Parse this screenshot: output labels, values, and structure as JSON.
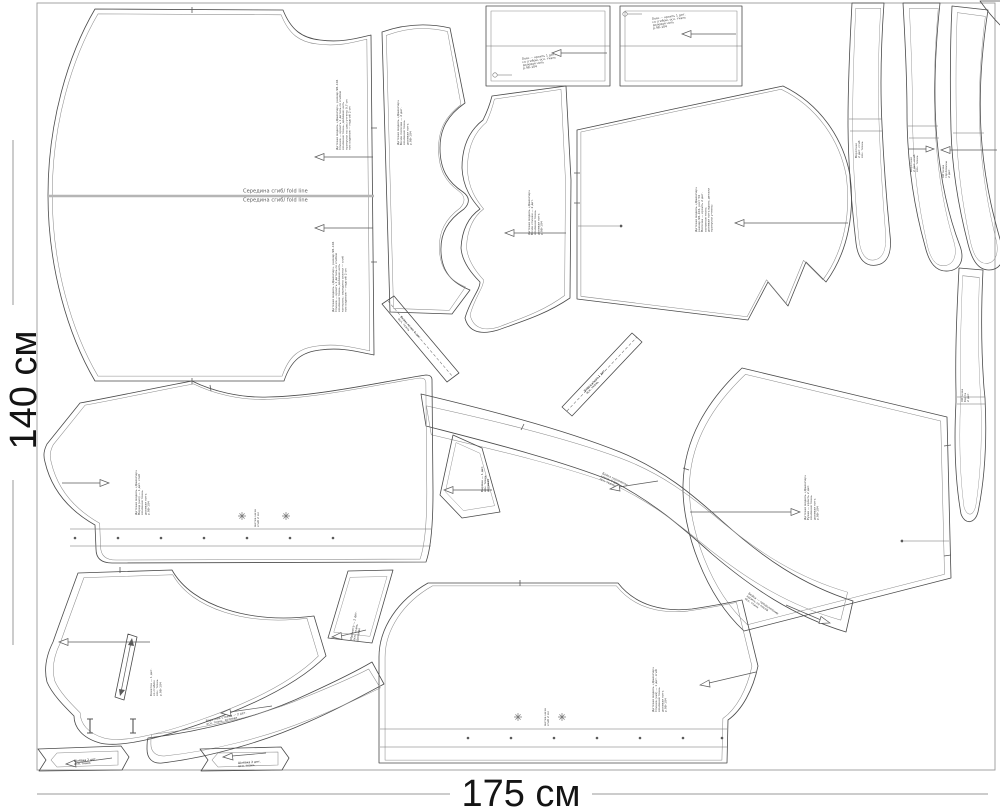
{
  "page": {
    "background": "#ffffff",
    "piece_line_color": "#4a4a4a",
    "inner_line_color": "#8a8a8a",
    "fold_line_color": "#b5b5b5",
    "dim_text_color": "#141414"
  },
  "dimensions": {
    "height_label": "140 см",
    "width_label": "175 см"
  },
  "fold_line": {
    "label_above": "Середина сгиб/ fold line",
    "label_below": "Середина сгиб/ fold line"
  },
  "marks": {
    "dot_rows": [
      {
        "y": 538,
        "xs": [
          75,
          118,
          161,
          204,
          247,
          290,
          333
        ]
      },
      {
        "y": 738,
        "xs": [
          468,
          511,
          554,
          597,
          640,
          683,
          722
        ]
      }
    ],
    "crosses": [
      [
        242,
        516
      ],
      [
        286,
        516
      ],
      [
        518,
        717
      ],
      [
        562,
        717
      ]
    ]
  },
  "annotations": [
    {
      "id": "back-upper",
      "x": 338,
      "y": 150,
      "rot": -90,
      "dark": false,
      "lines": [
        "Детская модель «Джемпер», размер 98–104",
        "Спинка — кроить 1 деталь со сгибом",
        "основная ткань, долевая нить",
        "припуски на швы учтены 0,7 см",
        "низ изделия — подгиб 2 см"
      ]
    },
    {
      "id": "back-lower",
      "x": 334,
      "y": 312,
      "rot": -90,
      "dark": false,
      "lines": [
        "Детская модель «Джемпер», размер 98–104",
        "Спинка — кроить 1 деталь со сгибом",
        "основная ткань, долевая нить",
        "контроль: середина спинки — сгиб",
        "низ изделия — подгиб 2 см"
      ]
    },
    {
      "id": "waistband-1",
      "x": 522,
      "y": 60,
      "rot": -8,
      "dark": false,
      "lines": [
        "Пояс — кроить 1 дет.",
        "со сгибом, осн. ткань",
        "долевая нить",
        "р.98–104"
      ]
    },
    {
      "id": "waistband-2",
      "x": 652,
      "y": 20,
      "rot": -8,
      "dark": false,
      "lines": [
        "Пояс — кроить 1 дет.",
        "со сгибом, осн. ткань",
        "долевая нить",
        "р.98–104"
      ]
    },
    {
      "id": "side-panel",
      "x": 399,
      "y": 145,
      "rot": -90,
      "dark": false,
      "lines": [
        "Детская модель «Джемпер»",
        "Бочок полочки — 2 дет.",
        "основная ткань",
        "долевая нить",
        "р.98–104"
      ]
    },
    {
      "id": "front-side",
      "x": 530,
      "y": 235,
      "rot": -90,
      "dark": false,
      "lines": [
        "Детская модель «Джемпер»",
        "Бочок спинки — 2 дет.",
        "основная ткань",
        "долевая нить",
        "р.98–104"
      ]
    },
    {
      "id": "front-bodice",
      "x": 697,
      "y": 232,
      "rot": -90,
      "dark": false,
      "lines": [
        "Детская модель «Джемпер»",
        "размер 98–104, рост 56",
        "Полочка — кроить 2 дет.",
        "основная ткань",
        "долевая нить вдоль детали",
        "припуски учтены"
      ]
    },
    {
      "id": "collar-band-1",
      "x": 857,
      "y": 158,
      "rot": -90,
      "dark": false,
      "lines": [
        "Воротник",
        "2 дет. сгиб",
        "осн. ткань"
      ]
    },
    {
      "id": "collar-band-2",
      "x": 912,
      "y": 172,
      "rot": -90,
      "dark": false,
      "lines": [
        "Воротник",
        "2 дет. сгиб",
        "осн. ткань"
      ]
    },
    {
      "id": "collar-band-3",
      "x": 944,
      "y": 178,
      "rot": -90,
      "dark": false,
      "lines": [
        "Обтачка",
        "горловины",
        "2 дет."
      ]
    },
    {
      "id": "facing-strip",
      "x": 963,
      "y": 402,
      "rot": -90,
      "dark": false,
      "lines": [
        "Обтачка",
        "борта",
        "2 дет."
      ]
    },
    {
      "id": "sleeve",
      "x": 806,
      "y": 520,
      "rot": -90,
      "dark": false,
      "lines": [
        "Детская модель «Джемпер»",
        "Рукав — кроить 2 дет.",
        "основная ткань",
        "долевая нить",
        "р.98–104"
      ]
    },
    {
      "id": "neck-binding-mid",
      "x": 602,
      "y": 474,
      "rot": 25,
      "dark": false,
      "lines": [
        "Бейка горловины",
        "косая, 1 дет.",
        "осн. ткань"
      ]
    },
    {
      "id": "neck-binding-end",
      "x": 748,
      "y": 594,
      "rot": 35,
      "dark": false,
      "lines": [
        "Бейка — продолжение",
        "кроить по косой",
        "осн. ткань"
      ]
    },
    {
      "id": "front-lower",
      "x": 137,
      "y": 515,
      "rot": -90,
      "dark": false,
      "lines": [
        "Детская модель «Джемпер»",
        "Перед (низ) — 1 дет. сгиб",
        "основная ткань",
        "долевая нить",
        "р.98–104"
      ]
    },
    {
      "id": "front-lower-note",
      "x": 256,
      "y": 527,
      "rot": -90,
      "dark": false,
      "lines": [
        "метка низа",
        "сгиб 2 см"
      ]
    },
    {
      "id": "back-lower-piece",
      "x": 654,
      "y": 712,
      "rot": -90,
      "dark": false,
      "lines": [
        "Детская модель «Джемпер»",
        "Спинка (низ) — 1 дет. сгиб",
        "основная ткань",
        "долевая нить",
        "р.98–104"
      ]
    },
    {
      "id": "back-lower-note",
      "x": 546,
      "y": 726,
      "rot": -90,
      "dark": false,
      "lines": [
        "метка низа",
        "сгиб 2 см"
      ]
    },
    {
      "id": "yoke",
      "x": 152,
      "y": 696,
      "rot": -90,
      "dark": false,
      "lines": [
        "Кокетка — 1 дет.",
        "со сгибом",
        "осн. ткань",
        "р.98–104"
      ]
    },
    {
      "id": "collar-stand",
      "x": 206,
      "y": 722,
      "rot": -12,
      "dark": false,
      "lines": [
        "Воротник-стойка — 2 дет.",
        "осн. ткань, долевая"
      ]
    },
    {
      "id": "belt-loop-1",
      "x": 74,
      "y": 762,
      "rot": -5,
      "dark": true,
      "lines": [
        "Шлёвка 2 дет.",
        "осн. ткань"
      ]
    },
    {
      "id": "belt-loop-2",
      "x": 238,
      "y": 764,
      "rot": -4,
      "dark": true,
      "lines": [
        "Шлёвка 2 дет.",
        "осн. ткань"
      ]
    },
    {
      "id": "pocket",
      "x": 483,
      "y": 492,
      "rot": -90,
      "dark": true,
      "lines": [
        "Карман — 1 дет.",
        "осн. ткань",
        "долевая"
      ]
    },
    {
      "id": "bias-strip-1",
      "x": 400,
      "y": 317,
      "rot": 48,
      "dark": false,
      "lines": [
        "Бейка косая 1 дет.",
        "осн. ткань"
      ]
    },
    {
      "id": "bias-strip-2",
      "x": 585,
      "y": 392,
      "rot": -46,
      "dark": true,
      "lines": [
        "Бейка косая 1 дет.",
        "осн. ткань"
      ]
    },
    {
      "id": "cuff",
      "x": 352,
      "y": 640,
      "rot": -80,
      "dark": false,
      "lines": [
        "Манжета — 2 дет.",
        "осн. ткань",
        "долевая"
      ]
    }
  ]
}
